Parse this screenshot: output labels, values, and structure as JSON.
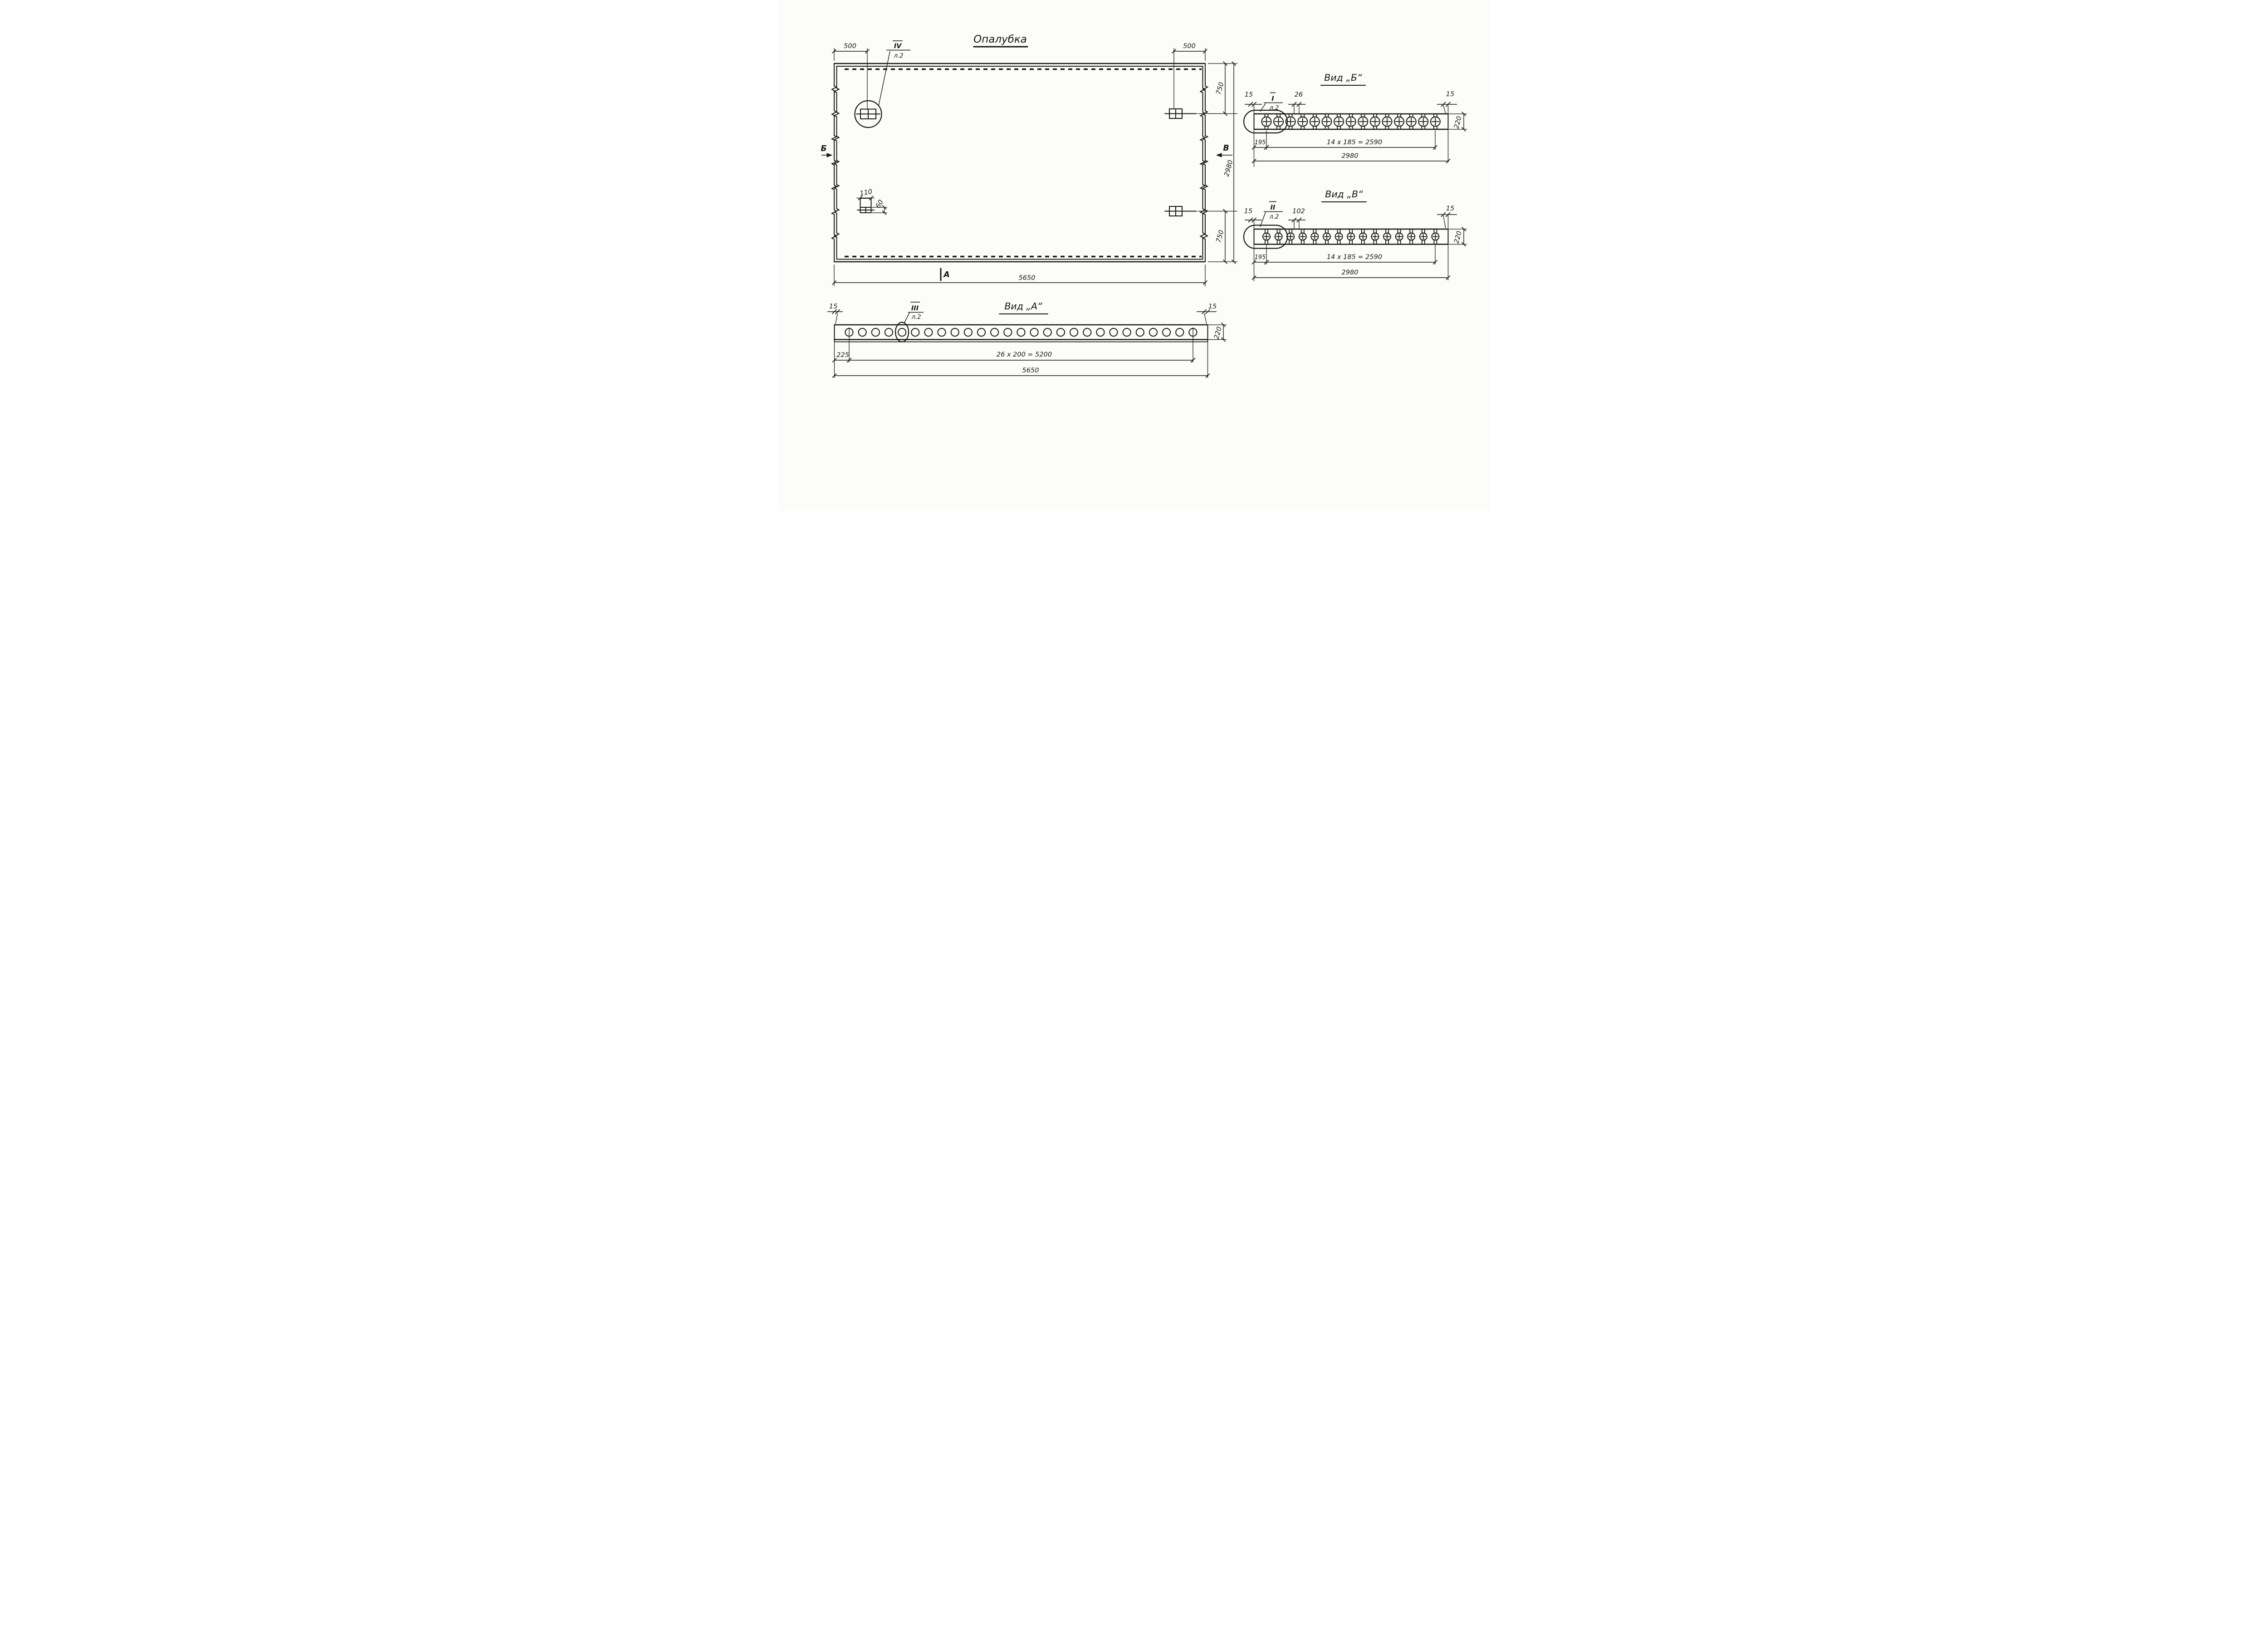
{
  "meta": {
    "title": "Опалубка"
  },
  "colors": {
    "ink": "#161616",
    "paper": "#fcfcfa"
  },
  "plan": {
    "section_left": "Б",
    "section_right": "В",
    "section_bottom": "А",
    "callout_ref": "IV",
    "callout_sheet": "л.2",
    "dim_left_offset": "500",
    "dim_right_offset": "500",
    "dim_top_750": "750",
    "dim_bottom_750": "750",
    "dim_height": "2980",
    "dim_width": "5650",
    "detail_width": "110",
    "detail_height": "60"
  },
  "view_a": {
    "title": "Вид „А“",
    "callout_ref": "III",
    "callout_sheet": "л.2",
    "dim_edge_left": "15",
    "dim_edge_right": "15",
    "dim_first": "225",
    "dim_pitch": "26 x 200 = 5200",
    "dim_total": "5650",
    "dim_height": "220",
    "hole_count": 27
  },
  "view_b": {
    "title": "Вид „Б“",
    "callout_ref": "I",
    "callout_sheet": "л.2",
    "dim_edge_left": "15",
    "dim_gap": "26",
    "dim_edge_right": "15",
    "dim_height": "220",
    "dim_first": "195",
    "dim_pitch": "14 x 185 = 2590",
    "dim_total": "2980",
    "hole_count": 15
  },
  "view_v": {
    "title": "Вид „В“",
    "callout_ref": "II",
    "callout_sheet": "л.2",
    "dim_edge_left": "15",
    "dim_gap": "102",
    "dim_edge_right": "15",
    "dim_height": "220",
    "dim_first": "195",
    "dim_pitch": "14 x 185 = 2590",
    "dim_total": "2980",
    "hole_count": 15
  }
}
